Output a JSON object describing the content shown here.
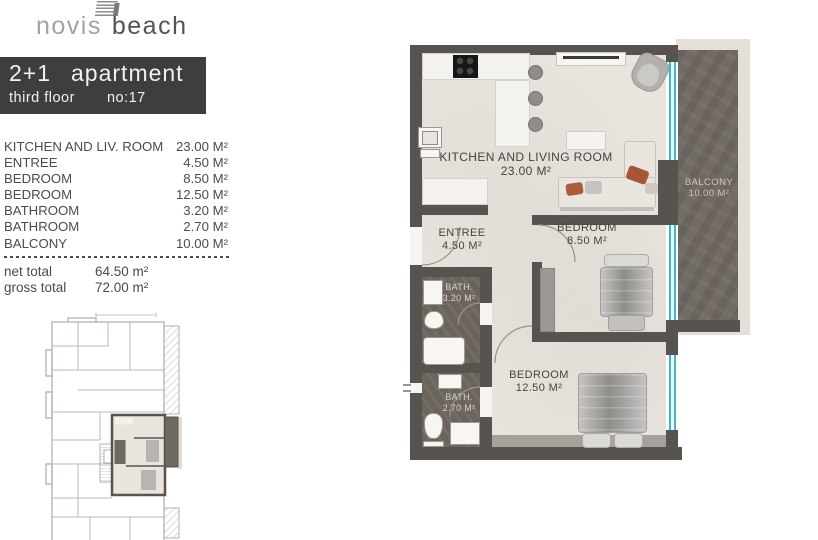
{
  "logo": {
    "light": "novis",
    "bold": "beach"
  },
  "title": {
    "size": "2+1",
    "kind": "apartment",
    "floor": "third floor",
    "unit": "no:17"
  },
  "rooms": [
    {
      "name": "KITCHEN AND LIV. ROOM",
      "area": "23.00 M²"
    },
    {
      "name": "ENTREE",
      "area": "4.50 M²"
    },
    {
      "name": "BEDROOM",
      "area": "8.50 M²"
    },
    {
      "name": "BEDROOM",
      "area": "12.50 M²"
    },
    {
      "name": "BATHROOM",
      "area": "3.20 M²"
    },
    {
      "name": "BATHROOM",
      "area": "2.70 M²"
    },
    {
      "name": "BALCONY",
      "area": "10.00 M²"
    }
  ],
  "totals": [
    {
      "label": "net total",
      "value": "64.50 m²"
    },
    {
      "label": "gross total",
      "value": "72.00 m²"
    }
  ],
  "plan": {
    "living": {
      "label": "KITCHEN AND LIVING ROOM",
      "area": "23.00 M²"
    },
    "entree": {
      "label": "ENTREE",
      "area": "4.50 M²"
    },
    "bedroom1": {
      "label": "BEDROOM",
      "area": "8.50 M²"
    },
    "bedroom2": {
      "label": "BEDROOM",
      "area": "12.50 M²"
    },
    "bath1": {
      "label": "BATH.",
      "area": "3.20 M²"
    },
    "bath2": {
      "label": "BATH.",
      "area": "2.70 M²"
    },
    "balcony": {
      "label": "BALCONY",
      "area": "10.00 M²"
    }
  },
  "colors": {
    "title_box_bg": "#3e3e3e",
    "wall": "#57534f",
    "floor": "#e9e4dd",
    "wet_floor": "#6b645c",
    "balcony_floor": "#716b64",
    "window_glass": "#3eb7cb",
    "counter": "#f3f2ee",
    "accent_pillow": "#ad5b3a"
  }
}
